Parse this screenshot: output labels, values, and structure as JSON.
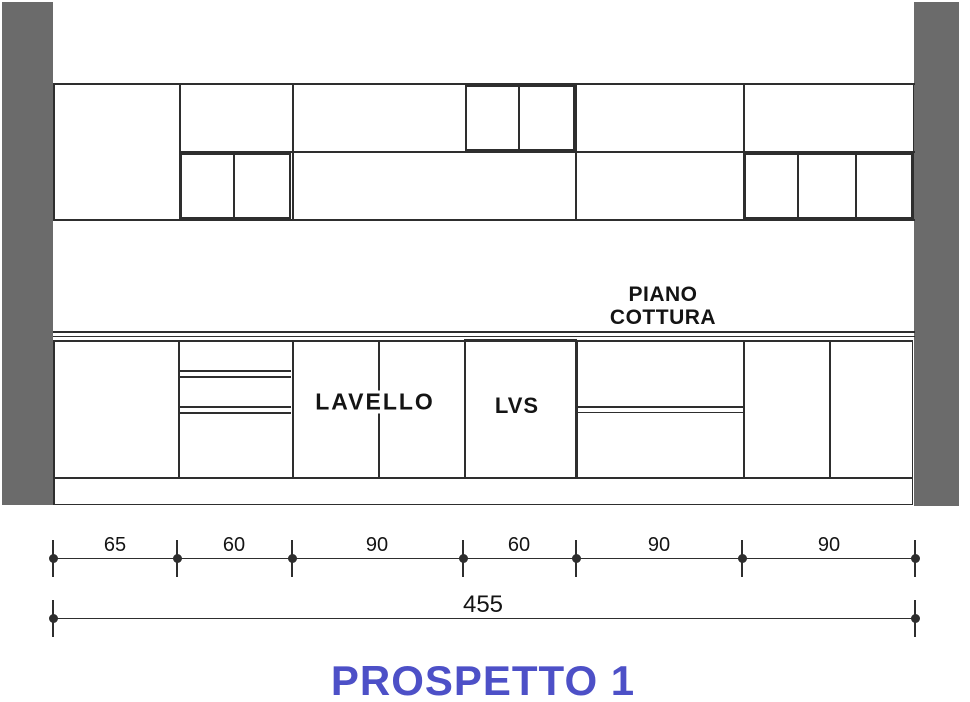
{
  "title": {
    "text": "PROSPETTO 1"
  },
  "labels": {
    "hob_line1": "PIANO",
    "hob_line2": "COTTURA",
    "sink": "LAVELLO",
    "dishwasher": "LVS"
  },
  "dimensions": {
    "unit": "cm",
    "segments": [
      {
        "label": "65",
        "value": 65
      },
      {
        "label": "60",
        "value": 60
      },
      {
        "label": "90",
        "value": 90
      },
      {
        "label": "60",
        "value": 60
      },
      {
        "label": "90",
        "value": 90
      },
      {
        "label": "90",
        "value": 90
      }
    ],
    "total": {
      "label": "455",
      "value": 455
    }
  },
  "colors": {
    "wall": "#6b6b6b",
    "line": "#2e2e2e",
    "title": "#4d50c7",
    "text": "#141414",
    "background": "#ffffff"
  }
}
